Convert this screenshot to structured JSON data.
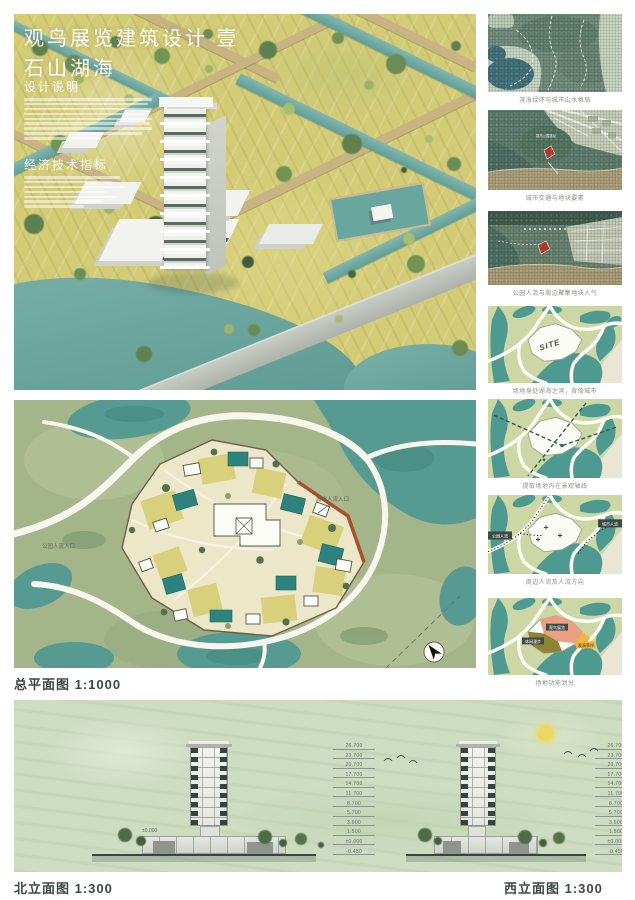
{
  "poster": {
    "title": "观鸟展览建筑设计 壹",
    "subtitle": "石山湖海",
    "design_notes_heading": "设计说明",
    "tech_index_heading": "经济技术指标"
  },
  "site_plan": {
    "label": "总平面图 1:1000",
    "entrance_city": "城市人流入口",
    "entrance_park": "公园人流入口"
  },
  "analysis_column": {
    "captions": [
      "滨海绿环与城市山水格局",
      "城市交通与地块要素",
      "公园人流与周边聚集地块人气",
      "场地身处湖海之滨，背倚城市",
      "提取场地内在景观轴线",
      "周边人流及人流方向",
      "场地功能划分"
    ],
    "site_label": "SITE",
    "marker_label": "观鸟公园选址",
    "flow_left": "公园人流",
    "flow_right": "城市人流",
    "zones": [
      "观鸟展览",
      "休闲漫步",
      "观演草坪"
    ]
  },
  "elevations": {
    "north_label": "北立面图 1:300",
    "west_label": "西立面图 1:300",
    "datum": "±0.000",
    "levels": [
      "26.700",
      "23.700",
      "20.700",
      "17.700",
      "14.700",
      "11.700",
      "8.700",
      "5.700",
      "3.900",
      "1.500",
      "±0.000",
      "-0.450"
    ]
  },
  "colors": {
    "meadow": "#d3cb76",
    "water": "#5f9e97",
    "plan_land": "#a5b58a",
    "diagram_teal": "#4f9a90",
    "diagram_land": "#cdd6a5",
    "site_red_edge": "#a8502c",
    "zone_salmon": "#eca083",
    "zone_olive": "#8f8435",
    "zone_orange": "#f2b445",
    "elevation_bg": "#cedcc2",
    "label_ink": "#3c4845"
  }
}
